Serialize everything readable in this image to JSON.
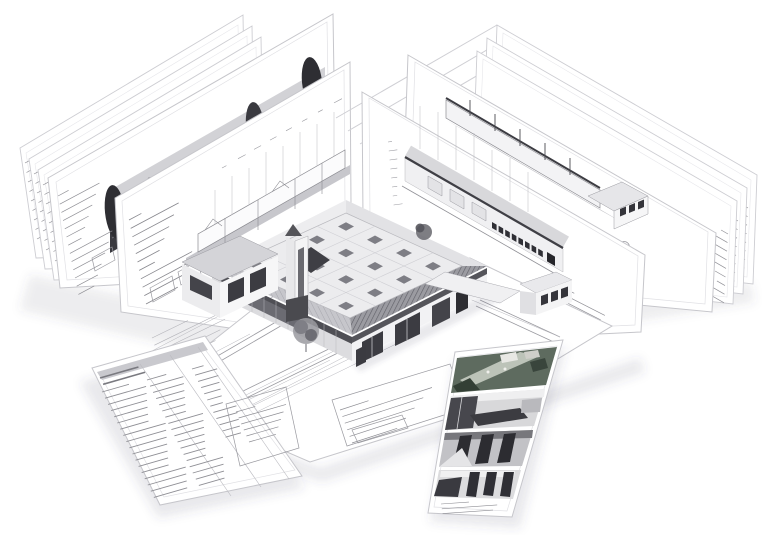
{
  "scene": {
    "description": "Isometric illustration of BIM architectural documentation",
    "sheets": [
      {
        "name": "left-back-sheet-1",
        "kind": "blank drawing sheet with title column"
      },
      {
        "name": "left-back-sheet-2",
        "kind": "blank drawing sheet with title column"
      },
      {
        "name": "left-back-sheet-3",
        "kind": "blank drawing sheet with title column"
      },
      {
        "name": "rendered-elevation-sheet",
        "kind": "dark rendered street elevation with trees"
      },
      {
        "name": "building-section-sheet",
        "kind": "line-drawn building section with grid stems"
      },
      {
        "name": "right-back-sheet-1",
        "kind": "blank drawing sheet with title column"
      },
      {
        "name": "right-back-sheet-2",
        "kind": "blank drawing sheet with title column"
      },
      {
        "name": "right-back-sheet-3",
        "kind": "blank drawing sheet with title column"
      },
      {
        "name": "cutaway-axon-sheet",
        "kind": "3D sectional cutaway on grey plinth"
      },
      {
        "name": "line-elevation-sheet",
        "kind": "long single-storey elevation with window row"
      },
      {
        "name": "floor-plan-sheet",
        "kind": "flat ground-plane floor plan with dimensions"
      },
      {
        "name": "schedule-sheet",
        "kind": "flat sheet with dense schedule table"
      },
      {
        "name": "photo-strip-sheet",
        "kind": "flat strip with four rendered views"
      }
    ],
    "building": {
      "kind": "hip-roofed school-like building model",
      "features": [
        "roof skylight grid",
        "roof opening",
        "corner tower",
        "left annex",
        "right wing pavilion",
        "storefront windows",
        "entry trees"
      ]
    },
    "photos": [
      {
        "name": "aerial-site-view",
        "tint": "green"
      },
      {
        "name": "interior-meeting-room",
        "tint": "grey"
      },
      {
        "name": "window-frames-view",
        "tint": "dark grey"
      },
      {
        "name": "interior-hall-view",
        "tint": "grey"
      }
    ]
  },
  "colors": {
    "paper": "#ffffff",
    "paper_edge": "#c6c6cb",
    "render_roof": "#d2d2d6",
    "render_facade": "#3a3a40",
    "render_stripe": "#6a6a70",
    "eave_dark": "#6f6f75",
    "roof_plane": "#ececee",
    "skylight": "#7e7e85",
    "roof_opening": "#3f3f45",
    "wall_light": "#f2f2f4",
    "wall_shade": "#dcdcdf",
    "window_dark": "#3c3c42",
    "plinth_grey": "#c3c3c8",
    "photo_green_base": "#5e6b5f",
    "photo_green_dark": "#333f35",
    "photo_green_path": "#cdd2c8",
    "photo_grey_bg": "#d8d8da",
    "photo_frame_dark": "#2c2c31",
    "table_dark": "#3c3c41",
    "ground_band": "#c7c7cc",
    "schedule_header": "#c9c9ce",
    "microtext": "#8e8e94"
  },
  "building": {
    "skylights": [
      [
        346,
        226.5
      ],
      [
        375,
        239.75
      ],
      [
        404,
        253
      ],
      [
        433,
        266.25
      ],
      [
        317,
        239.75
      ],
      [
        346,
        253
      ],
      [
        375,
        266.25
      ],
      [
        404,
        279.5
      ],
      [
        317,
        266.25
      ],
      [
        346,
        279.5
      ],
      [
        375,
        292.75
      ],
      [
        259,
        266.25
      ],
      [
        288,
        279.5
      ],
      [
        317,
        292.75
      ],
      [
        346,
        305.9
      ]
    ]
  },
  "microlines": [
    {
      "name": "tL1",
      "x": 25,
      "y": 163,
      "step": [
        1.5,
        9.5
      ],
      "rows": 9,
      "angle": -28,
      "len": [
        8,
        20
      ],
      "color": "#8e8e94",
      "width": 0.7
    },
    {
      "name": "tL2",
      "x": 34,
      "y": 174,
      "step": [
        1.5,
        9.5
      ],
      "rows": 9,
      "angle": -28,
      "len": [
        8,
        20
      ],
      "color": "#8e8e94",
      "width": 0.7
    },
    {
      "name": "tL3",
      "x": 43,
      "y": 185,
      "step": [
        1.5,
        9.5
      ],
      "rows": 9,
      "angle": -28,
      "len": [
        8,
        20
      ],
      "color": "#8e8e94",
      "width": 0.7
    },
    {
      "name": "tRender",
      "x": 58,
      "y": 196,
      "step": [
        1.7,
        8.2
      ],
      "rows": 13,
      "angle": -28,
      "len": [
        12,
        48
      ],
      "color": "#8e8e94",
      "width": 0.7
    },
    {
      "name": "tSection",
      "x": 129,
      "y": 220,
      "step": [
        1.7,
        8.4
      ],
      "rows": 11,
      "angle": -28,
      "len": [
        14,
        58
      ],
      "color": "#86868c",
      "width": 0.8
    },
    {
      "name": "secDims",
      "x": 222,
      "y": 168,
      "step": [
        16,
        -9.3
      ],
      "rows": 8,
      "angle": -28,
      "len": [
        5,
        9
      ],
      "color": "#9a9aa0",
      "width": 0.6
    },
    {
      "name": "rb1col",
      "x": 748,
      "y": 208,
      "step": [
        -0.5,
        8.6
      ],
      "rows": 9,
      "angle": 210,
      "len": [
        8,
        24
      ],
      "color": "#8e8e94",
      "width": 0.7
    },
    {
      "name": "rb2col",
      "x": 738,
      "y": 221,
      "step": [
        -0.5,
        8.6
      ],
      "rows": 9,
      "angle": 210,
      "len": [
        8,
        24
      ],
      "color": "#8e8e94",
      "width": 0.7
    },
    {
      "name": "rb3col",
      "x": 728,
      "y": 234,
      "step": [
        -0.5,
        8.6
      ],
      "rows": 9,
      "angle": 210,
      "len": [
        8,
        24
      ],
      "color": "#8e8e94",
      "width": 0.7
    },
    {
      "name": "cutTitle",
      "x": 568,
      "y": 224,
      "step": [
        1.2,
        7.4
      ],
      "rows": 7,
      "angle": 27,
      "len": [
        20,
        62
      ],
      "color": "#86868c",
      "width": 0.8
    },
    {
      "name": "elevTitle",
      "x": 560,
      "y": 286,
      "step": [
        1.2,
        7.2
      ],
      "rows": 6,
      "angle": 27,
      "len": [
        16,
        52
      ],
      "color": "#8e8e94",
      "width": 0.7
    },
    {
      "name": "elevDims",
      "x": 388,
      "y": 142,
      "step": [
        0.8,
        9
      ],
      "rows": 8,
      "angle": -8,
      "len": [
        4,
        9
      ],
      "color": "#9a9aa0",
      "width": 0.6
    },
    {
      "name": "schedHead",
      "x": 100,
      "y": 378,
      "step": [
        3.1,
        6.3
      ],
      "rows": 2,
      "angle": -16,
      "len": [
        40,
        44
      ],
      "color": "#7a7a80",
      "width": 1.6
    },
    {
      "name": "schedA",
      "x": 102,
      "y": 392,
      "step": [
        3.05,
        6.2
      ],
      "rows": 18,
      "angle": -16,
      "len": [
        28,
        44
      ],
      "color": "#8f8f95",
      "width": 0.9
    },
    {
      "name": "schedB",
      "x": 147,
      "y": 380,
      "step": [
        3.05,
        6.2
      ],
      "rows": 18,
      "angle": -16,
      "len": [
        20,
        36
      ],
      "color": "#8f8f95",
      "width": 0.9
    },
    {
      "name": "schedC",
      "x": 192,
      "y": 369,
      "step": [
        3.05,
        6.2
      ],
      "rows": 12,
      "angle": -16,
      "len": [
        12,
        24
      ],
      "color": "#8f8f95",
      "width": 0.9
    },
    {
      "name": "schedForm",
      "x": 236,
      "y": 412,
      "step": [
        2.6,
        6.0
      ],
      "rows": 6,
      "angle": -16,
      "len": [
        20,
        52
      ],
      "color": "#8e8e94",
      "width": 0.7
    },
    {
      "name": "planDims",
      "x": 240,
      "y": 404,
      "step": [
        3.4,
        6.4
      ],
      "rows": 3,
      "angle": -26,
      "len": [
        100,
        210
      ],
      "color": "#b6b6bc",
      "width": 0.5
    },
    {
      "name": "planForm",
      "x": 340,
      "y": 410,
      "step": [
        2.4,
        6.6
      ],
      "rows": 6,
      "angle": -18,
      "len": [
        30,
        100
      ],
      "color": "#8e8e94",
      "width": 0.7
    },
    {
      "name": "planLeft",
      "x": 152,
      "y": 338,
      "step": [
        2.4,
        7.2
      ],
      "rows": 5,
      "angle": -26,
      "len": [
        40,
        88
      ],
      "color": "#b2b2b8",
      "width": 0.6
    },
    {
      "name": "stripTitle",
      "x": 441,
      "y": 504,
      "step": [
        0.8,
        4.8
      ],
      "rows": 3,
      "angle": -4,
      "len": [
        28,
        58
      ],
      "color": "#8e8e94",
      "width": 0.6
    }
  ]
}
